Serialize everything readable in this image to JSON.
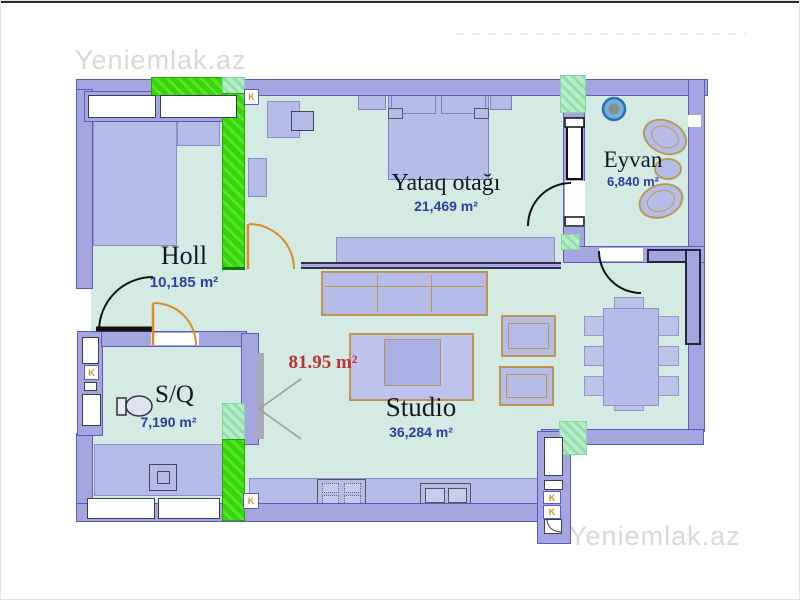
{
  "watermarks": {
    "top_left": "Yeniemlak.az",
    "bottom_right": "Yeniemlak.az"
  },
  "plan": {
    "total_area": "81.95 m²",
    "rooms": {
      "bedroom": {
        "name": "Yataq otağı",
        "area": "21,469 m²"
      },
      "balcony": {
        "name": "Eyvan",
        "area": "6,840 m²"
      },
      "hall": {
        "name": "Holl",
        "area": "10,185 m²"
      },
      "bathroom": {
        "name": "S/Q",
        "area": "7,190 m²"
      },
      "studio": {
        "name": "Studio",
        "area": "36,284 m²"
      }
    },
    "vent_label": "K",
    "colors": {
      "wall_fill": "#a5a5e0",
      "wall_edge": "#5c5abf",
      "floor": "#d3ebe2",
      "furniture": "#b6bce8",
      "furniture_edge": "#bd9452",
      "renovation_green": "#35d606",
      "renovation_mint": "#b9ecc9",
      "door_orange": "#dd8a22",
      "door_black": "#111111",
      "room_text": "#15152a",
      "area_text": "#2b3fa8",
      "total_text": "#c03232",
      "vent_text": "#c89432",
      "watermark_text": "#d9d9d9"
    }
  }
}
